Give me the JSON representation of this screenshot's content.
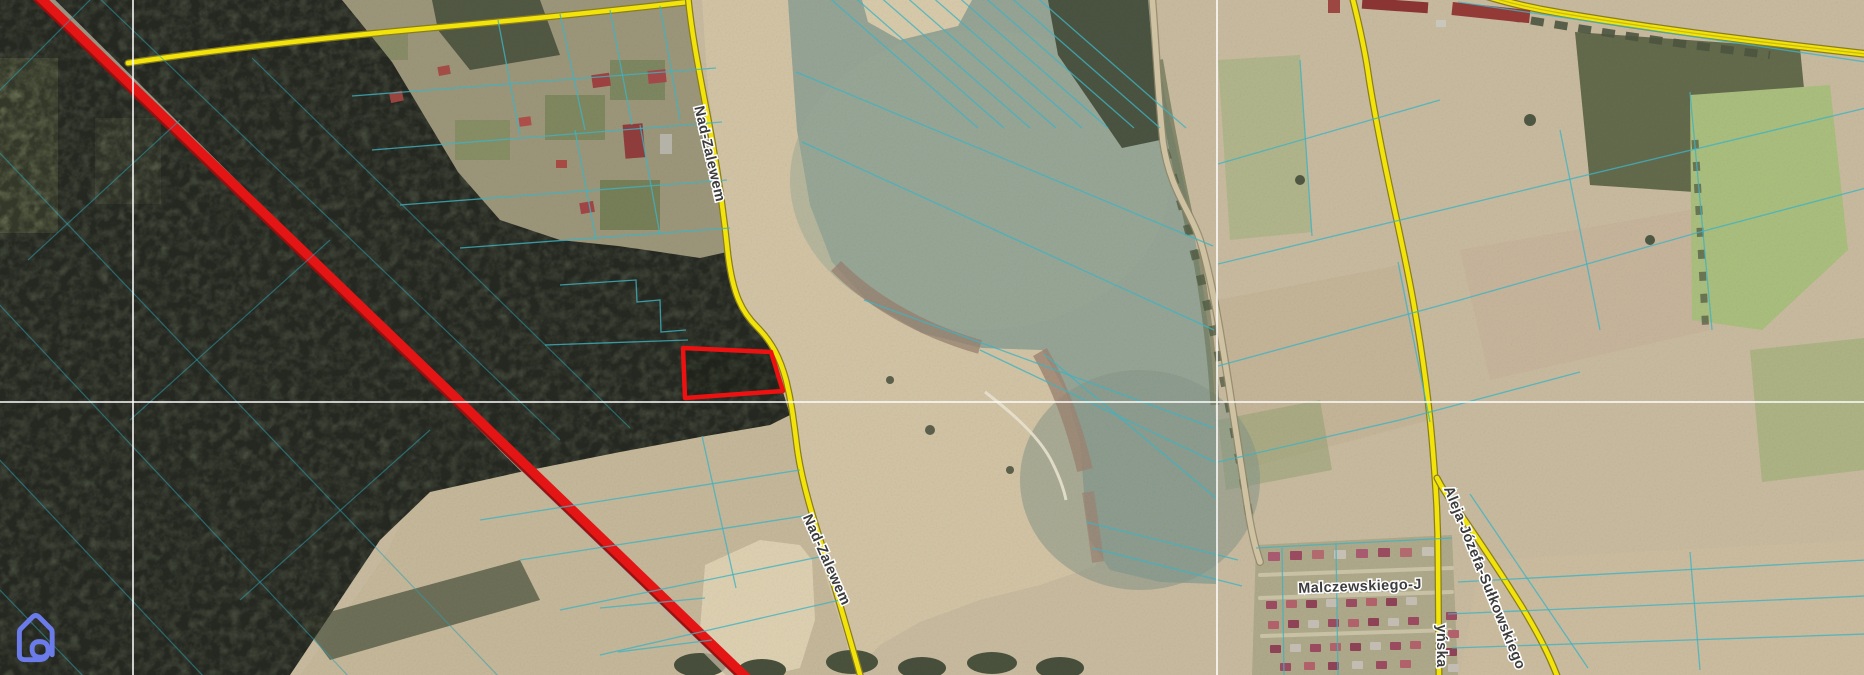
{
  "map": {
    "type": "aerial-cadastral-map",
    "street_labels": [
      {
        "id": "nad-zalewem-upper",
        "text": "Nad-Zalewem"
      },
      {
        "id": "nad-zalewem-lower",
        "text": "Nad-Zalewem"
      },
      {
        "id": "aleja-jozefa-sulkowskiego",
        "text": "Aleja-Józefa-Sułkowskiego"
      },
      {
        "id": "malczewskiego",
        "text": "Malczewskiego-J"
      },
      {
        "id": "ynska-partial",
        "text": "yńska"
      }
    ],
    "selected_parcel": {
      "outline_color": "#ee1111"
    },
    "colors": {
      "cadastral_lines": "#3fb3c2",
      "survey_grid": "#ffffff",
      "road_primary": "#f2e40a",
      "railway": "#e31515",
      "water": "#95a394",
      "forest": "#4b5142",
      "logo": "#6b7bea",
      "label_text": "#3c3c3c"
    },
    "icons": {
      "watermark": "house-loop-logo-icon"
    }
  }
}
